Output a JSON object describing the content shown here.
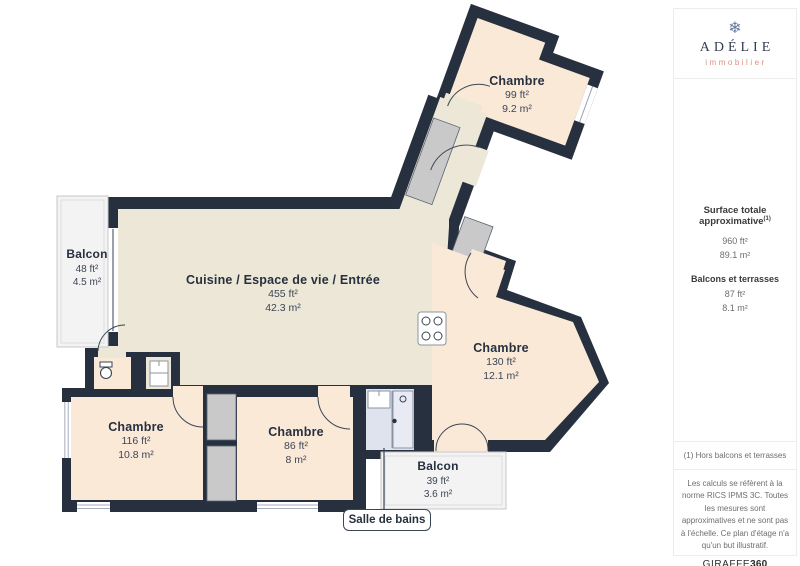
{
  "plan": {
    "rooms": [
      {
        "id": "chambre-top",
        "name": "Chambre",
        "ft": "99 ft²",
        "m": "9.2 m²"
      },
      {
        "id": "living",
        "name": "Cuisine / Espace de vie / Entrée",
        "ft": "455 ft²",
        "m": "42.3 m²"
      },
      {
        "id": "balcon-left",
        "name": "Balcon",
        "ft": "48 ft²",
        "m": "4.5 m²"
      },
      {
        "id": "chambre-right",
        "name": "Chambre",
        "ft": "130 ft²",
        "m": "12.1 m²"
      },
      {
        "id": "chambre-bottom-left",
        "name": "Chambre",
        "ft": "116 ft²",
        "m": "10.8 m²"
      },
      {
        "id": "chambre-bottom-middle",
        "name": "Chambre",
        "ft": "86 ft²",
        "m": "8 m²"
      },
      {
        "id": "balcon-bottom",
        "name": "Balcon",
        "ft": "39 ft²",
        "m": "3.6 m²"
      }
    ],
    "callout": {
      "label": "Salle de bains"
    }
  },
  "sidebar": {
    "logo": {
      "icon": "snowflake-icon",
      "glyph": "❄",
      "brand": "ADÉLIE",
      "sub": "immobilier"
    },
    "metrics": {
      "title": "Surface totale approximative",
      "title_sup": "(1)",
      "total_ft": "960 ft²",
      "total_m": "89.1 m²",
      "balconies_title": "Balcons et terrasses",
      "balconies_ft": "87 ft²",
      "balconies_m": "8.1 m²"
    },
    "footnote": "(1) Hors balcons et terrasses",
    "disclaimer": "Les calculs se réfèrent à la norme RICS IPMS 3C. Toutes les mesures sont approximatives et ne sont pas à l'échelle. Ce plan d'étage n'a qu'un but illustratif.",
    "credit": {
      "name": "GIRAFFE",
      "suffix": "360"
    }
  },
  "colors": {
    "wall": "#26303f",
    "living": "#ece7d7",
    "bedroom": "#fbe9d8",
    "balcony": "#f3f3f3",
    "bathroom": "#dfe3ee",
    "closet": "#c9c9c9",
    "accent_logo": "#dd8f80"
  }
}
